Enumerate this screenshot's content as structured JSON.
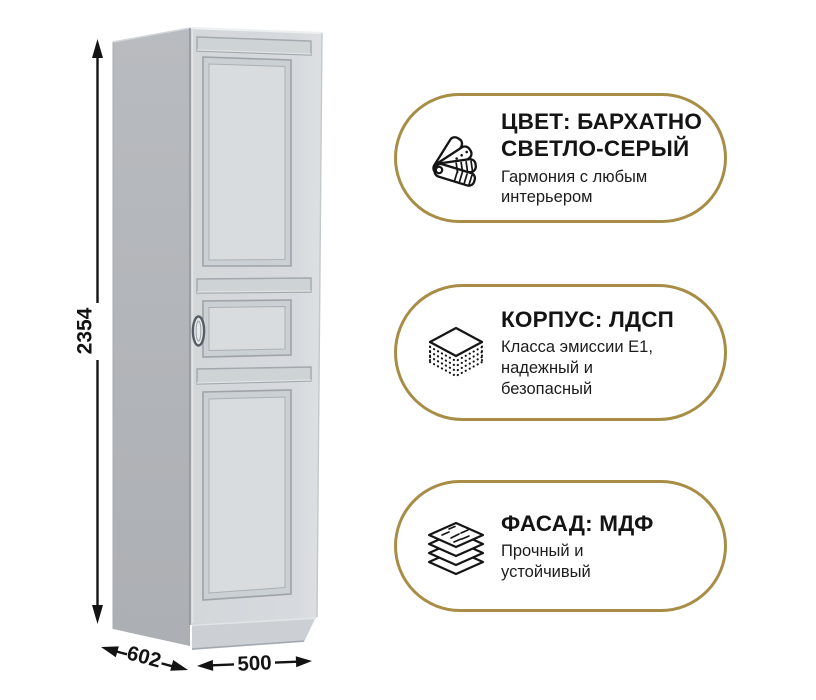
{
  "wardrobe": {
    "dimensions": {
      "height_mm": "2354",
      "depth_mm": "602",
      "width_mm": "500"
    }
  },
  "features": [
    {
      "icon": "color-swatches-icon",
      "title_lines": [
        "ЦВЕТ: БАРХАТНО",
        "СВЕТЛО-СЕРЫЙ"
      ],
      "subtitle_lines": [
        "Гармония с любым",
        "интерьером"
      ]
    },
    {
      "icon": "chipboard-layers-icon",
      "title_lines": [
        "КОРПУС: ЛДСП"
      ],
      "subtitle_lines": [
        "Класса эмиссии E1,",
        "надежный и",
        "безопасный"
      ]
    },
    {
      "icon": "mdf-sheets-icon",
      "title_lines": [
        "ФАСАД: МДФ"
      ],
      "subtitle_lines": [
        "Прочный и",
        "устойчивый"
      ]
    }
  ],
  "colors": {
    "background": "#ffffff",
    "badge_border": "#a88d46",
    "text_primary": "#141414",
    "wardrobe_side": "#b3b6ba",
    "wardrobe_front": "#d5d9dc",
    "wardrobe_panel_field": "#d8dcdf",
    "wardrobe_plinth": "#ccd0d4"
  }
}
